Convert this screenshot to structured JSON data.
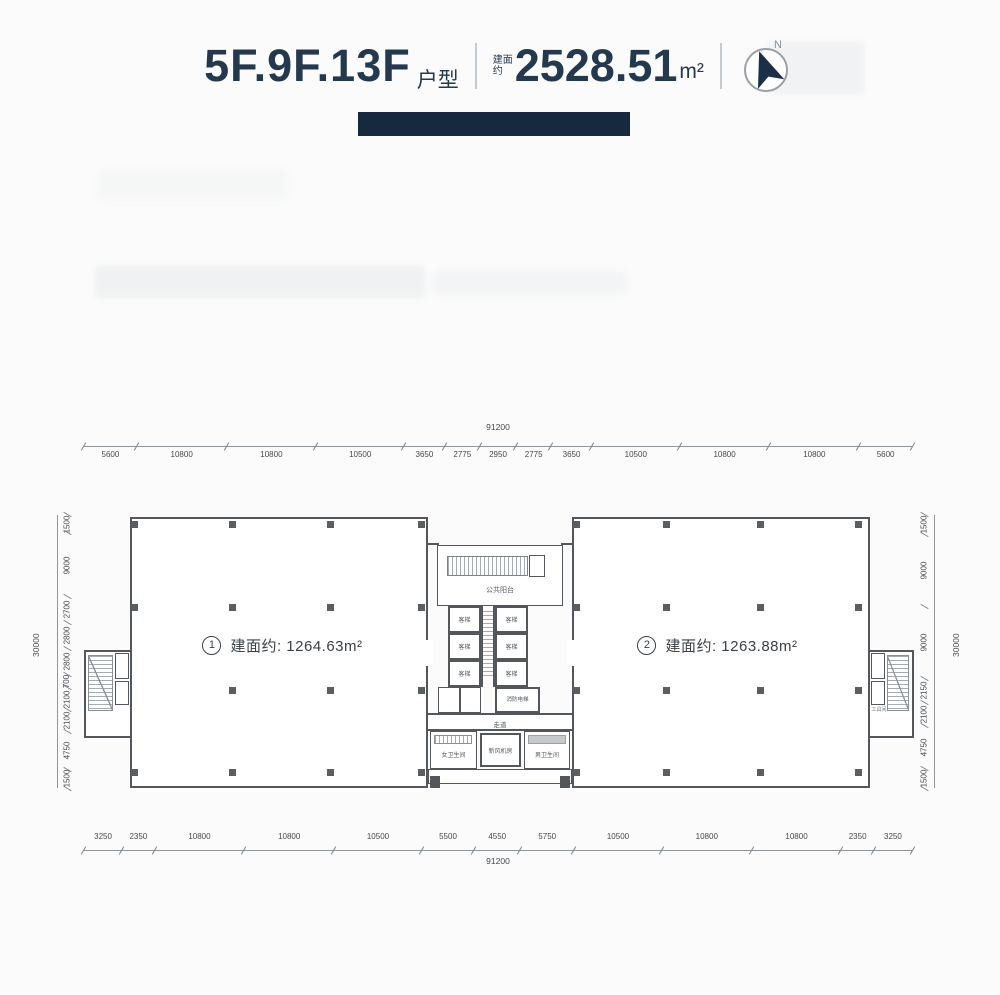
{
  "header": {
    "title": "5F.9F.13F",
    "title_suffix": "户型",
    "area_prefix_line1": "建面",
    "area_prefix_line2": "约",
    "total_area": "2528.51",
    "area_unit": "m²",
    "compass_label": "N",
    "accent_color": "#16293f"
  },
  "units": [
    {
      "number": "1",
      "label": "建面约: 1264.63m²"
    },
    {
      "number": "2",
      "label": "建面约: 1263.88m²"
    }
  ],
  "core": {
    "balcony": "公共阳台",
    "elevator": "客梯",
    "fire_elevator": "消防电梯",
    "corridor": "走道",
    "womens_restroom": "女卫生间",
    "fresh_air_room": "新风机房",
    "mens_restroom": "男卫生间",
    "tool_room": "工具间"
  },
  "dimensions": {
    "top": {
      "total": "91200",
      "segments": [
        5600,
        10800,
        10800,
        10500,
        3650,
        2775,
        2950,
        2775,
        3650,
        10500,
        10800,
        10800,
        5600
      ]
    },
    "bottom": {
      "total": "91200",
      "segments": [
        3250,
        2350,
        10800,
        10800,
        10500,
        5500,
        4550,
        5750,
        10500,
        10800,
        10800,
        2350,
        3250
      ]
    },
    "left": {
      "total": "30000",
      "segments": [
        1500,
        9000,
        2700,
        2800,
        2800,
        700,
        2100,
        2100,
        4750,
        1500
      ]
    },
    "right": {
      "total": "30000",
      "segments": [
        1500,
        9000,
        9000,
        2150,
        2100,
        4750,
        1500
      ]
    }
  }
}
